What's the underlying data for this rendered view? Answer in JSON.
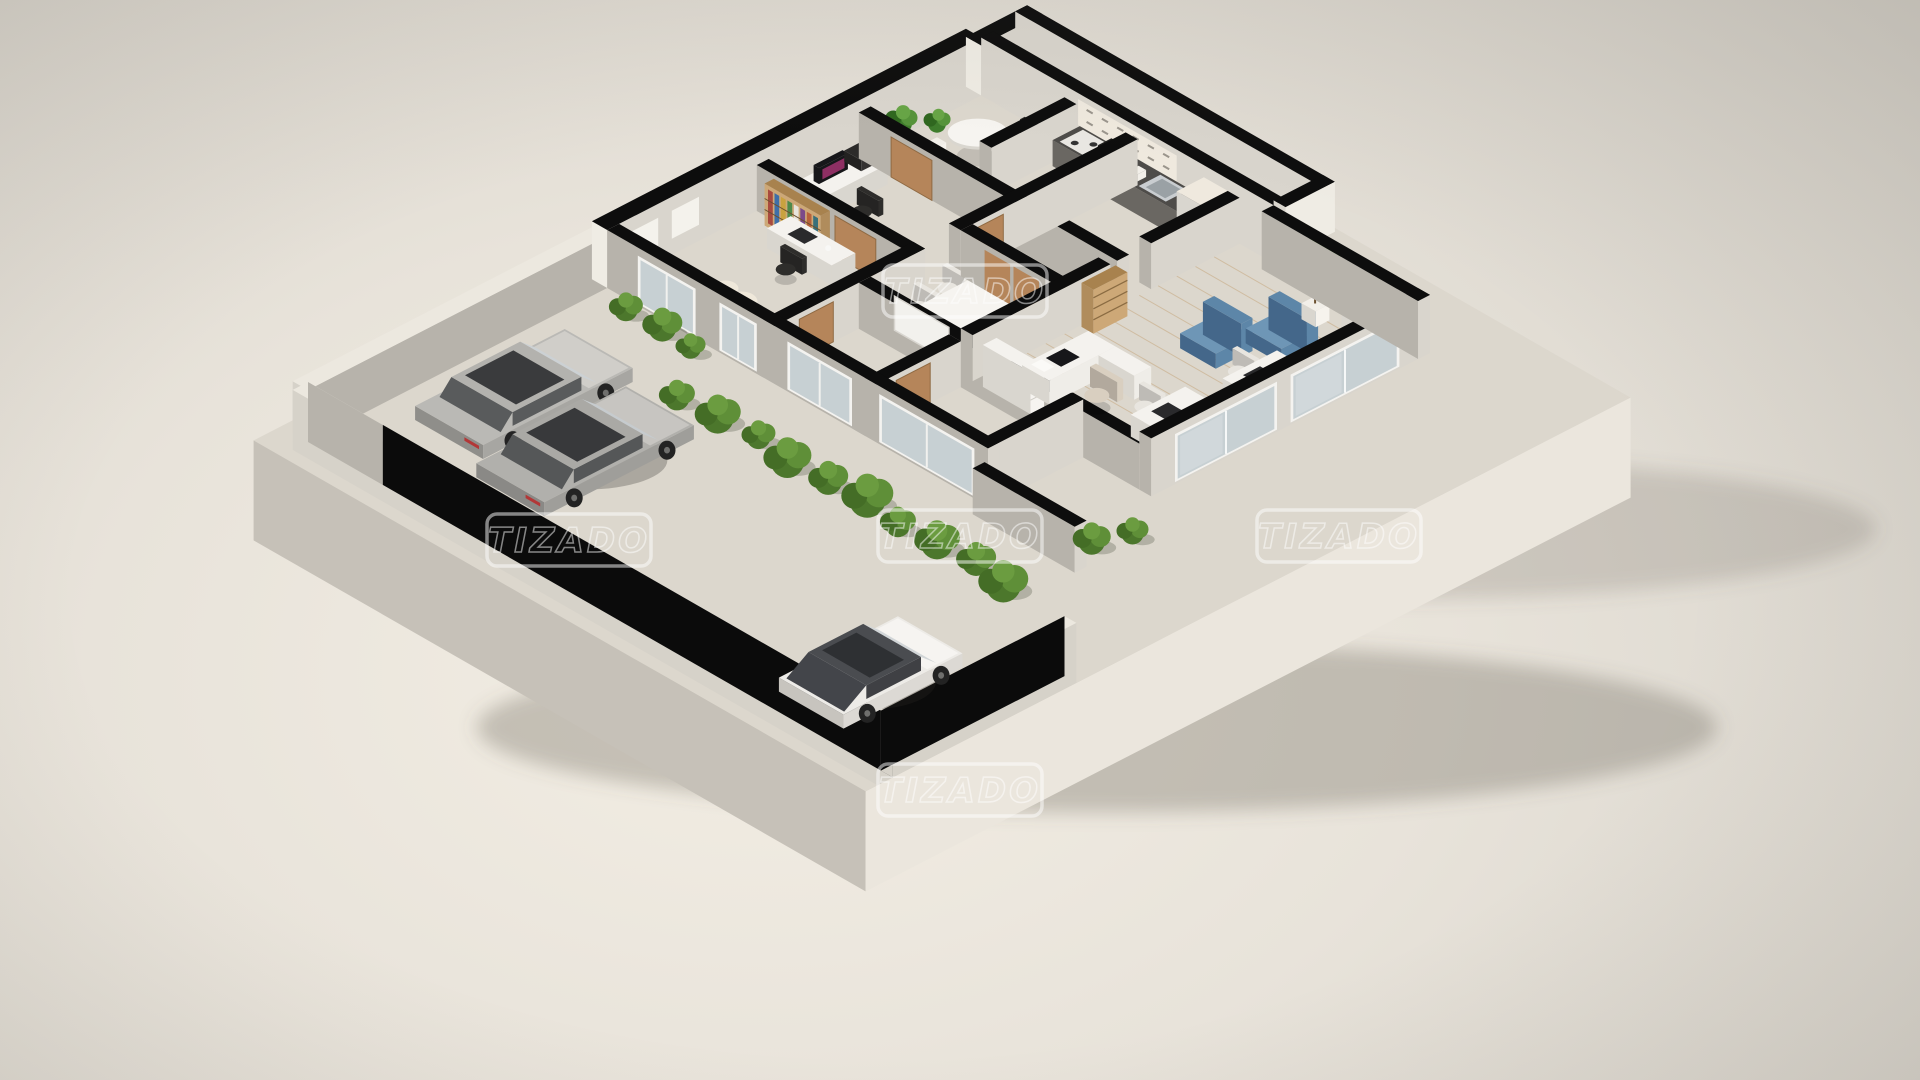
{
  "meta": {
    "description": "3D isometric cutaway floor plan render of a furnished unit with parking court, garden hedge and open office/living wing",
    "render_style": "photoreal-3d-floorplan"
  },
  "watermark": {
    "text": "TIZADO",
    "color": "#ffffff",
    "opacity": 0.5,
    "positions": [
      {
        "x": 965,
        "y": 291
      },
      {
        "x": 569,
        "y": 540
      },
      {
        "x": 960,
        "y": 536
      },
      {
        "x": 1339,
        "y": 536
      },
      {
        "x": 960,
        "y": 790
      }
    ]
  },
  "palette": {
    "bgCenter": "#f3eee4",
    "bgEdge": "#d3cfc7",
    "slabTop": "#dcd7cd",
    "slabLeft": "#c6c1b8",
    "slabRight": "#ebe6dd",
    "pavement": "#908d89",
    "path": "#a3a09a",
    "grass": "#6f9340",
    "grassDark": "#5e8135",
    "lawn": "#7e8851",
    "bushDark": "#446d26",
    "bushMid": "#4c772c",
    "bushLight": "#5f8f38",
    "bushPale": "#6b9c40",
    "wallCap": "#0d0d0d",
    "wallLight": "#d9d5cd",
    "wallDark": "#b7b3ab",
    "wallWhite": "#efece4",
    "boundCap": "#ece8df",
    "boundFace": "#d6d2c9",
    "garage": "#0b0b0b",
    "floorTan": "#c79f80",
    "floorTan2": "#c9a98c",
    "floorTan3": "#c7a183",
    "floorTan4": "#d3bda6",
    "floorWhite": "#e9e5dd",
    "floorKitchen": "#b8b4ad",
    "floorConf": "#dbd2c6",
    "floorWood": "#d6ba97",
    "floorTerrace": "#e2ddd3",
    "plank": "#c3a277",
    "door": "#b5855a",
    "glass": "#c7d0d3",
    "glassFrame": "#f4f3f0",
    "counterTop": "#4e4c49",
    "counterFace": "#6a6762",
    "cabinet": "#efe9de",
    "handle": "#9a958c",
    "steel": "#c9cdd0",
    "applianceDark": "#1f1e1d",
    "rug": "#b29d6b",
    "rugEdge": "#a08c5c",
    "blueSeatTop": "#6e96b6",
    "blueSeat": "#5d86a8",
    "blueSeatDark": "#44678a",
    "deskWhite": "#f4f2ee",
    "deskShade": "#d9d6cf",
    "tableWhite": "#f6f4f0",
    "chairDark": "#2e2d2b",
    "chairWhite": "#e8e5df",
    "chairCream": "#d9cfc0",
    "cream": "#efe8da",
    "monitor": "#17171a",
    "screenGlow": "#8e2f63",
    "pot": "#f2efe9",
    "woodShelf": "#cda877",
    "woodShelfDark": "#a8824e",
    "shelfLine": "#8a6b42",
    "whiteboard": "#f2f1ed",
    "cooler": "#f0ede7",
    "coolerBlue": "#7fb2c9",
    "plantDark": "#2f671f",
    "plantMid": "#3e7c2c",
    "plantLight": "#55933a",
    "plantPale": "#67a546",
    "wheel": "#232323",
    "hub": "#6f6f6d",
    "taillight": "#b23737",
    "shadow": "rgba(45,42,38,0.28)",
    "books": [
      "#a84a3f",
      "#3f6fa8",
      "#c9a23f",
      "#4e8a4a",
      "#e8e4dc",
      "#7a4a8a",
      "#b8623a",
      "#39707a"
    ],
    "carSilver1": {
      "body": "#bab9b5",
      "shade": "#8f8e8a",
      "side": "#a7a6a2",
      "roof": "#b3b2ae",
      "glassLight": "#ccd1d4",
      "glassDark": "#595b5c",
      "sunroof": "#3a3b3d",
      "hood": "#d0cec9",
      "tail": true
    },
    "carSilver2": {
      "body": "#b1b0ac",
      "shade": "#8a8986",
      "side": "#9f9e9a",
      "roof": "#aaa9a5",
      "glassLight": "#c6cbce",
      "glassDark": "#555758",
      "sunroof": "#38393b",
      "hood": "#c7c5c1",
      "tail": true
    },
    "carWhite": {
      "body": "#edebe7",
      "shade": "#c7c4be",
      "side": "#dcd9d4",
      "roof": "#4a4c50",
      "glassLight": "#d2d6d8",
      "glassDark": "#3f4044",
      "sunroof": "#2e3033",
      "hood": "#f6f4f1",
      "hatch": "#43454a"
    }
  },
  "scene": {
    "type": "isometric-3d-floor-plan-render",
    "watermark_count": 5,
    "outdoor": {
      "parking": {
        "surface": "gray-concrete",
        "vehicles": [
          {
            "name": "silver-sedan-1"
          },
          {
            "name": "silver-sedan-2"
          },
          {
            "name": "white-hatchback"
          }
        ]
      },
      "garden": {
        "features": [
          "hedge-row",
          "grass-strip",
          "olive-lawn",
          "shrubs-along-facade",
          "garden-wall"
        ]
      },
      "boundary": "white-perimeter-wall-with-dark-inner-face"
    },
    "interior": {
      "rooms": [
        {
          "name": "bedroom-office-1",
          "floor": "terracotta",
          "furniture": [
            "cream-armchair",
            "white-desk",
            "black-office-chair",
            "color-bookshelf",
            "wall-panels",
            "wood-door"
          ]
        },
        {
          "name": "office-2",
          "floor": "terracotta-light",
          "furniture": [
            "white-desk",
            "monitor-magenta-screen",
            "printer",
            "office-chair",
            "wood-door"
          ]
        },
        {
          "name": "staff-dining-room",
          "floor": "white",
          "furniture": [
            "round-white-table",
            "two-dark-chairs",
            "two-potted-plants"
          ]
        },
        {
          "name": "kitchen",
          "floor": "gray",
          "furniture": [
            "dark-counter",
            "cooktop",
            "coffee-machine",
            "sink",
            "upper-cabinets",
            "tall-cabinet"
          ]
        },
        {
          "name": "bathroom",
          "floor": "beige",
          "furniture": [
            "toilet",
            "washbasin"
          ]
        },
        {
          "name": "meeting-room",
          "floor": "light-beige",
          "furniture": [
            "white-table",
            "two-white-chairs",
            "whiteboard",
            "double-wood-doors"
          ]
        },
        {
          "name": "bedroom-3",
          "floor": "terracotta"
        },
        {
          "name": "bedroom-4",
          "floor": "terracotta"
        },
        {
          "name": "open-office-living",
          "floor": "light-wood-planks",
          "furniture": [
            "reception-desk",
            "beige-chair",
            "white-shelf",
            "wood-bookshelf",
            "khaki-area-rug",
            "two-blue-armchairs",
            "fiddle-leaf-fig-plant",
            "two-workstation-desks",
            "office-chairs",
            "water-cooler"
          ]
        },
        {
          "name": "side-terrace",
          "floor": "cream"
        }
      ],
      "glazing": [
        "sliding-glass-doors-garden-facade",
        "sliding-glass-doors-front-facade"
      ]
    }
  }
}
